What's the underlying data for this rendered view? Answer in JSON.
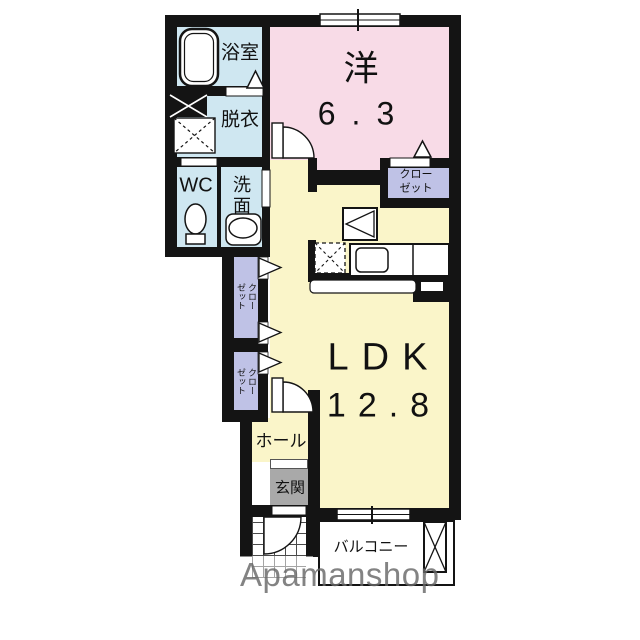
{
  "colors": {
    "wall": "#141414",
    "wet": "#cfe7f1",
    "western": "#f8dbe7",
    "ldk": "#faf5c9",
    "closet": "#bfc2e6",
    "genkan": "#a9a9a9",
    "watermark": "#686868"
  },
  "rooms": {
    "bathroom": {
      "label": "浴室"
    },
    "dressing": {
      "label": "脱衣"
    },
    "wc": {
      "label": "WC"
    },
    "washroom": {
      "char1": "洗",
      "char2": "面"
    },
    "western": {
      "label": "洋",
      "area": "6.3"
    },
    "closet_right": {
      "line1": "クロー",
      "line2": "ゼット"
    },
    "closet_left_upper": {
      "label": "クローゼット"
    },
    "closet_left_lower": {
      "label": "クローゼット"
    },
    "ldk": {
      "label": "LDK",
      "area": "12.8"
    },
    "hall": {
      "label": "ホール"
    },
    "entrance": {
      "label": "玄関"
    },
    "balcony": {
      "label": "バルコニー"
    }
  },
  "watermark": {
    "text": "Apamanshop"
  }
}
